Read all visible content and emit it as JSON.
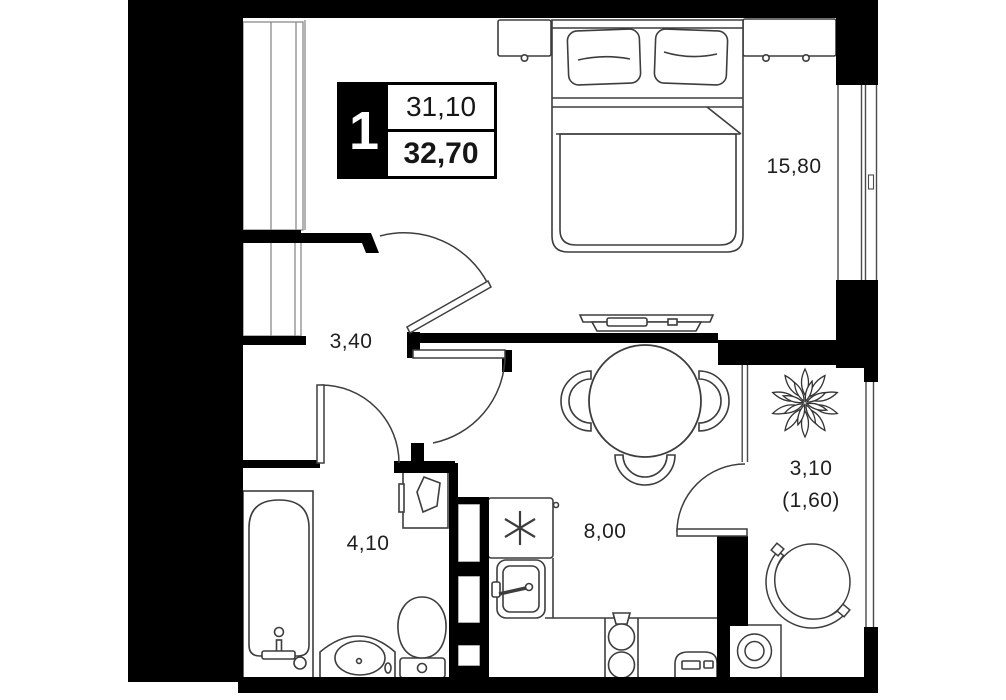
{
  "plan": {
    "type": "apartment-floor-plan",
    "badge": {
      "rooms": "1",
      "living_area": "31,10",
      "total_area": "32,70"
    },
    "rooms": [
      {
        "id": "bedroom",
        "area": "15,80"
      },
      {
        "id": "hallway",
        "area": "3,40"
      },
      {
        "id": "bathroom",
        "area": "4,10"
      },
      {
        "id": "kitchen",
        "area": "8,00"
      },
      {
        "id": "balcony",
        "area": "3,10",
        "area_reduced": "(1,60)"
      }
    ],
    "furniture": [
      "wardrobe",
      "double-bed",
      "pillows",
      "nightstand",
      "dresser",
      "tv-console",
      "dining-table",
      "chairs",
      "stove",
      "kitchen-sink",
      "hob",
      "oven",
      "vent-shaft",
      "bathtub",
      "vanity-sink",
      "toilet",
      "water-heater",
      "plant",
      "round-chair",
      "washing-machine"
    ],
    "colors": {
      "wall": "#000000",
      "furniture_line": "#3d3d3d",
      "light_line": "#8a8a8a",
      "text": "#1f1f1f",
      "background": "#ffffff"
    }
  }
}
